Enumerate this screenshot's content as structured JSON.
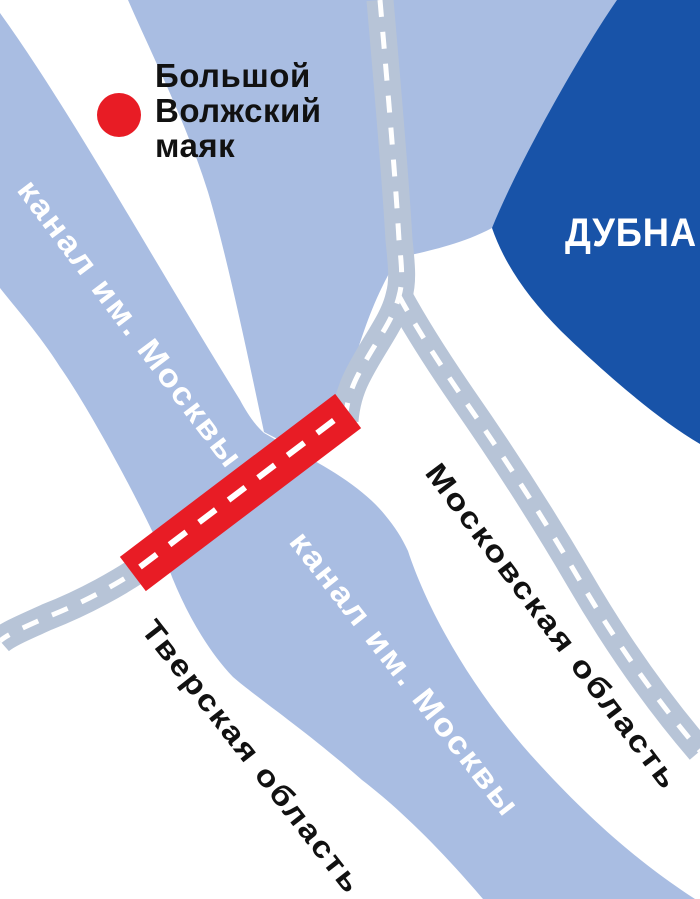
{
  "map": {
    "title": "Схема расположения Большого Волжского маяка",
    "labels": {
      "lighthouse_line1": "Большой",
      "lighthouse_line2": "Волжский",
      "lighthouse_line3": "маяк",
      "city": "ДУБНА",
      "canal_upper": "канал им. Москвы",
      "canal_lower": "канал им. Москвы",
      "region_right": "Московская область",
      "region_left": "Тверская область"
    },
    "colors": {
      "water": "#a9bde2",
      "city_area": "#1853a8",
      "road": "#b7c4d7",
      "road_dash": "#ffffff",
      "bridge": "#e81c25",
      "marker": "#e81c25",
      "label_dark": "#111111",
      "label_light": "#ffffff",
      "background": "#ffffff"
    }
  }
}
